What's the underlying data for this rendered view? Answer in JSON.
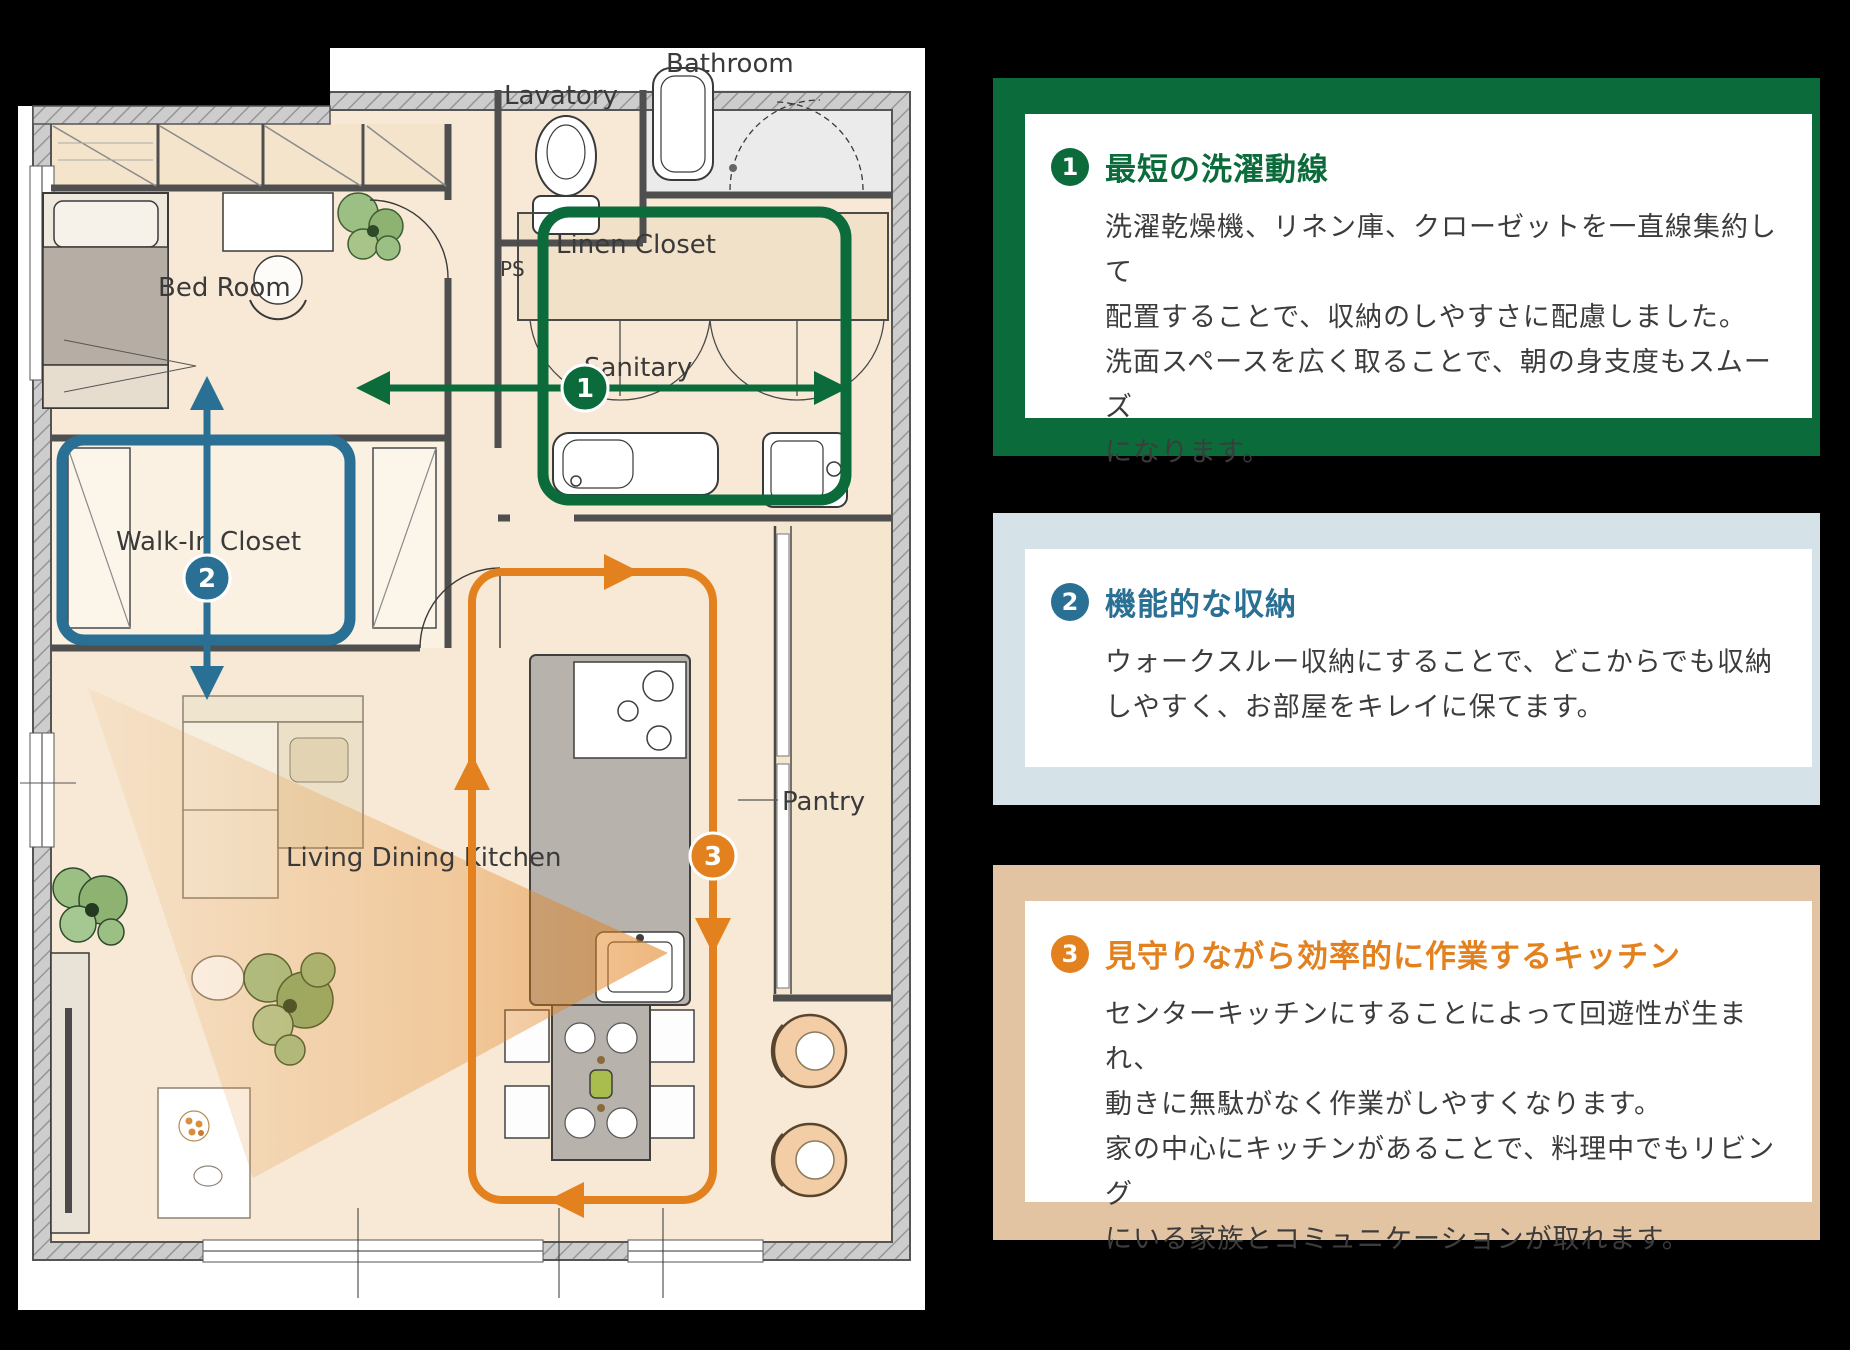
{
  "plan": {
    "labels": {
      "bedroom": "Bed Room",
      "wic": "Walk-In Closet",
      "lavatory": "Lavatory",
      "bathroom": "Bathroom",
      "linen": "Linen Closet",
      "sanitary": "Sanitary",
      "ps": "PS",
      "ldk": "Living Dining Kitchen",
      "pantry": "Pantry"
    },
    "routes": [
      {
        "no": "1",
        "name": "laundry-line",
        "color": "#0b6b3b"
      },
      {
        "no": "2",
        "name": "walk-through-storage",
        "color": "#2a7094"
      },
      {
        "no": "3",
        "name": "kitchen-circulation",
        "color": "#e2811d"
      }
    ]
  },
  "cards": [
    {
      "no": "1",
      "title": "最短の洗濯動線",
      "body": "洗濯乾燥機、リネン庫、クローゼットを一直線集約して\n配置することで、収納のしやすさに配慮しました。\n洗面スペースを広く取ることで、朝の身支度もスムーズ\nになります。",
      "accent": "#0b6b3b",
      "frame": "#0b6b3b"
    },
    {
      "no": "2",
      "title": "機能的な収納",
      "body": "ウォークスルー収納にすることで、どこからでも収納\nしやすく、お部屋をキレイに保てます。",
      "accent": "#2a7094",
      "frame": "#d5e3e8"
    },
    {
      "no": "3",
      "title": "見守りながら効率的に作業するキッチン",
      "body": "センターキッチンにすることによって回遊性が生まれ、\n動きに無駄がなく作業がしやすくなります。\n家の中心にキッチンがあることで、料理中でもリビング\nにいる家族とコミュニケーションが取れます。",
      "accent": "#e2811d",
      "frame": "#e3c4a2"
    }
  ]
}
